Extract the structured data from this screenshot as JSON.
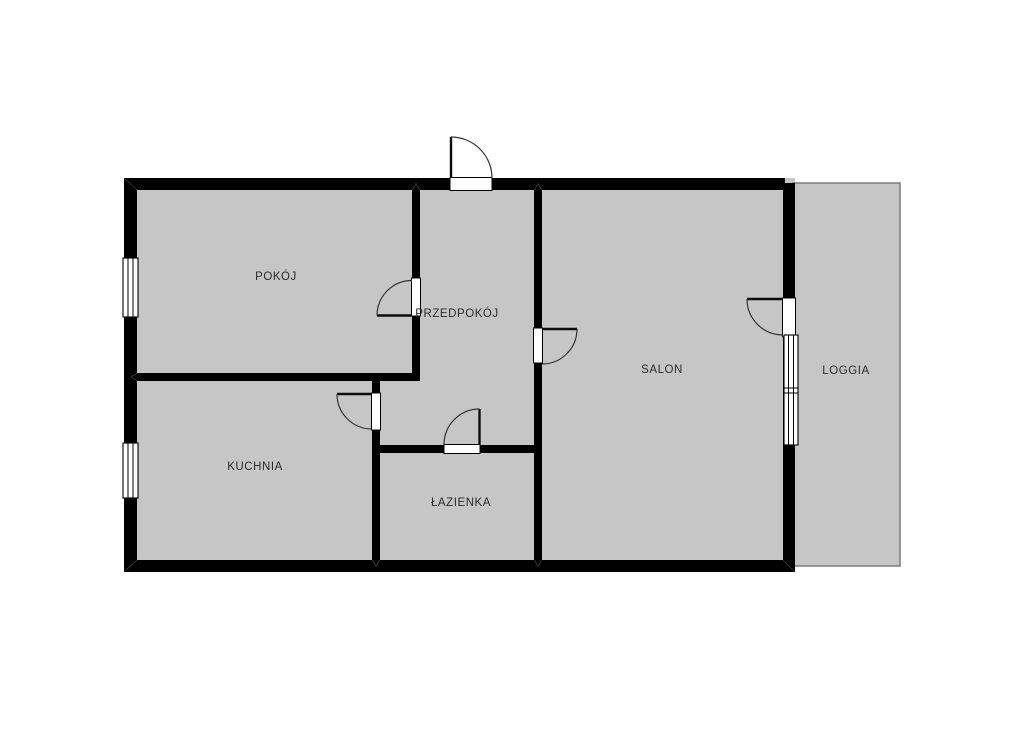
{
  "plan": {
    "colors": {
      "background": "#ffffff",
      "floor_fill": "#c6c6c6",
      "wall": "#000000",
      "opening": "#ffffff",
      "loggia_border": "#7b7b7b",
      "label_text": "#2b2b2b"
    },
    "rooms": {
      "pokoj": {
        "label": "POKÓJ"
      },
      "przedpokoj": {
        "label": "PRZEDPOKÓJ"
      },
      "salon": {
        "label": "SALON"
      },
      "kuchnia": {
        "label": "KUCHNIA"
      },
      "lazienka": {
        "label": "ŁAZIENKA"
      },
      "loggia": {
        "label": "LOGGIA"
      }
    }
  }
}
